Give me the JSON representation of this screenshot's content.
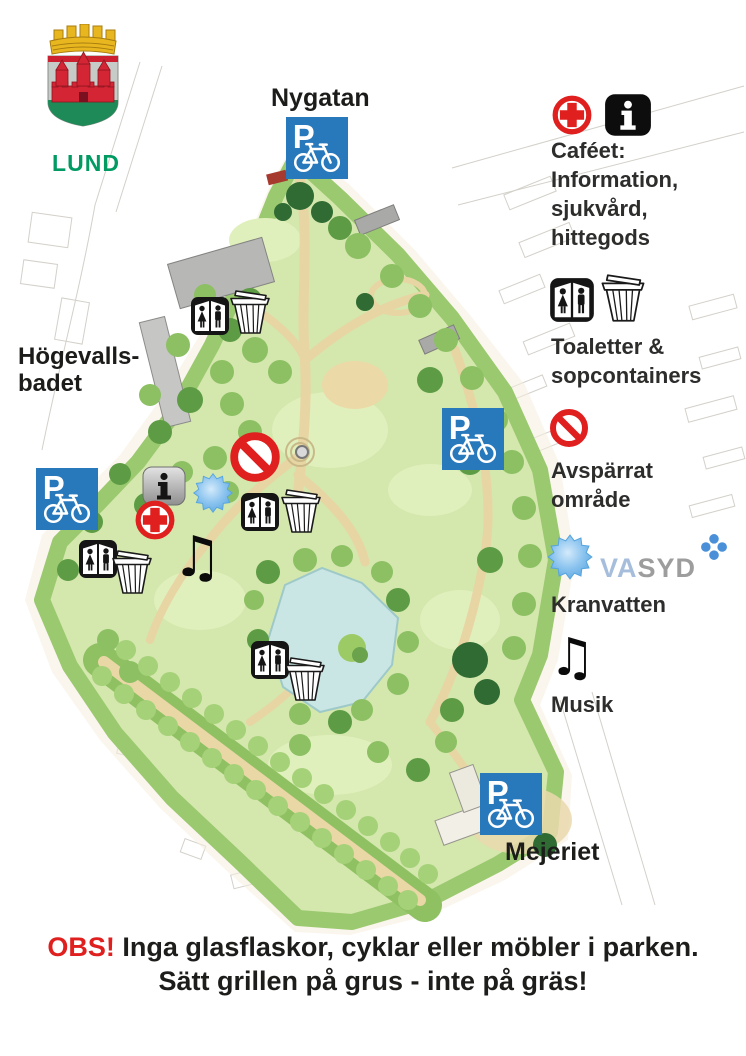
{
  "branding": {
    "city_name": "LUND"
  },
  "map": {
    "labels": {
      "street_top": "Nygatan",
      "pool_line1": "Högevalls-",
      "pool_line2": "badet",
      "venue_bottom": "Mejeriet"
    },
    "parking_letter": "P"
  },
  "legend": {
    "cafe": {
      "lines": [
        "Caféet:",
        "Information,",
        "sjukvård,",
        "hittegods"
      ]
    },
    "toilets": {
      "lines": [
        "Toaletter &",
        "sopcontainers"
      ]
    },
    "restricted": {
      "lines": [
        "Avspärrat",
        "område"
      ]
    },
    "water": {
      "label": "Kranvatten",
      "brand_va": "VA",
      "brand_syd": "SYD"
    },
    "music": {
      "label": "Musik"
    }
  },
  "notice": {
    "warning": "OBS!",
    "line1_rest": "Inga glasflaskor, cyklar eller möbler i parken.",
    "line2": "Sätt grillen på grus - inte på gräs!"
  },
  "icons": {
    "music_note": "♫"
  },
  "colors": {
    "parking_blue": "#2878bc",
    "alert_red": "#e01f1f",
    "lund_green": "#009a62",
    "water_blue": "#6fb5e9",
    "park_green": "#d4e7ad"
  }
}
